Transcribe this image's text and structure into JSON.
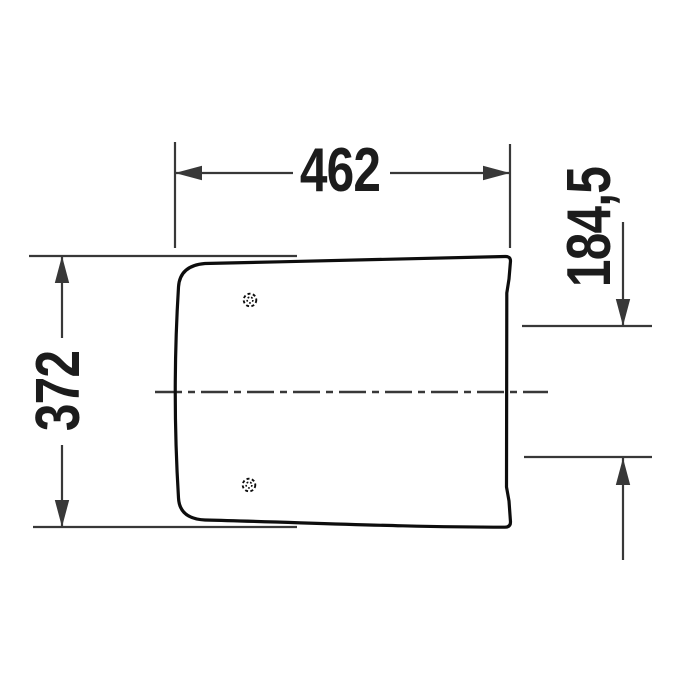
{
  "drawing": {
    "type": "technical-dimension-drawing",
    "subject": "seat-lid-outline-top-view",
    "dimensions": {
      "width": {
        "label": "462",
        "orientation": "horizontal",
        "position": "top"
      },
      "depth": {
        "label": "372",
        "orientation": "vertical-rotated",
        "position": "left"
      },
      "offset": {
        "label": "184,5",
        "orientation": "vertical-rotated",
        "position": "right"
      }
    },
    "features": {
      "hinge_hole_count": 2,
      "centerline": "horizontal-dash-dot"
    },
    "colors": {
      "background": "#ffffff",
      "outline": "#0d0d0d",
      "line": "#383838",
      "text": "#1c1c1c"
    }
  }
}
